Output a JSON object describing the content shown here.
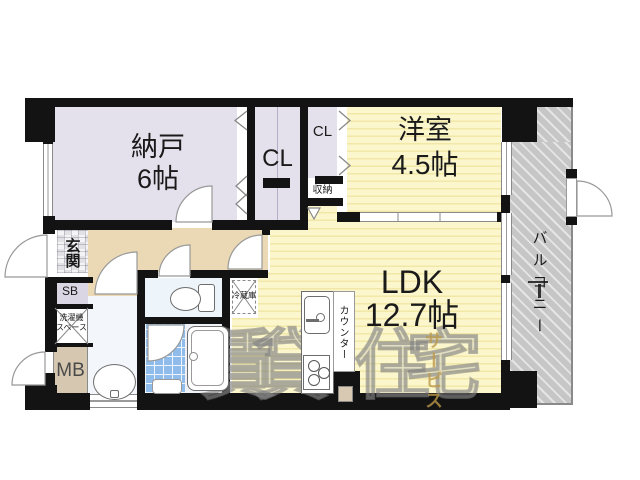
{
  "rooms": {
    "nando": {
      "name": "納戸",
      "size": "6帖"
    },
    "closet_main": {
      "name": "CL"
    },
    "closet_small": {
      "name": "CL"
    },
    "shuno": {
      "name": "収納"
    },
    "youshitsu": {
      "name": "洋室",
      "size": "4.5帖"
    },
    "ldk": {
      "name": "LDK",
      "size": "12.7帖"
    },
    "balcony": {
      "name": "バルコニー"
    },
    "genkan": {
      "name": "玄関"
    },
    "sb": {
      "name": "SB"
    },
    "mb": {
      "name": "MB"
    },
    "laundry": {
      "line1": "洗濯機",
      "line2": "スペース"
    },
    "fridge": {
      "name": "冷蔵庫"
    },
    "counter": {
      "name": "カウンター"
    }
  },
  "watermark": {
    "chars": [
      "賃",
      "貸",
      "住",
      "宅"
    ],
    "service": "サービス"
  },
  "colors": {
    "wall": "#131313",
    "room_lavender": "#e5e1ec",
    "room_yellow": "#f8f2c0",
    "hall_beige": "#ead9b4",
    "balcony_gray": "#c6c6c6",
    "bath_tile_blue": "#8fbceb",
    "toilet_blue": "#edf4fa",
    "mb_tan": "#d6c7b0",
    "sb_lavender": "#dbd6e4",
    "watermark_gray": "#9a9a9a",
    "watermark_gold": "#bc9848"
  }
}
